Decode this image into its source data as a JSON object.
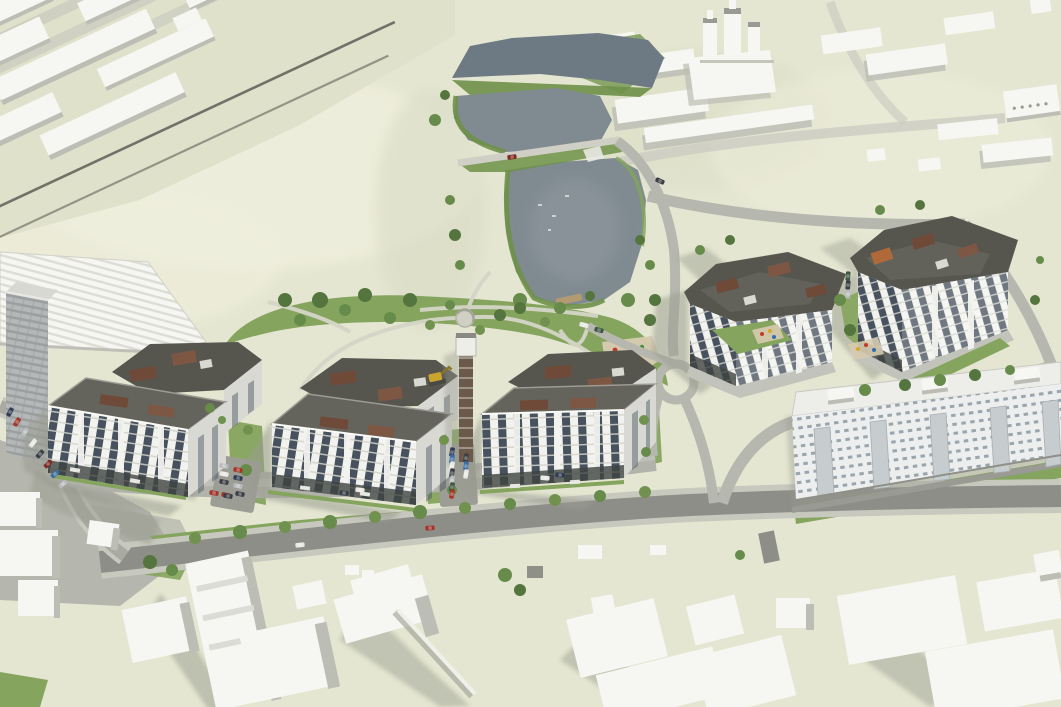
{
  "scene": {
    "type": "3d-architectural-rendering",
    "view": "aerial-axonometric",
    "description": "Aerial 3D visualization of a residential masterplan: a row of new white apartment blocks with dark roofs and brown penthouse accents along a tree-lined main road, a two-lobed pond with green banks and a dam road at the top, a landscaped park with winding paths and a playground, parking rows with cars, a construction hoist tower, white low-poly context buildings with a church complex on the upper plateau, railway corridor at top-left, and a long existing panel building at lower right.",
    "elements": [
      "terrain-hill",
      "railway-corridor",
      "context-buildings-north",
      "church-complex",
      "pond-upper",
      "pond-lower",
      "dam-road",
      "park-with-paths",
      "playground",
      "residential-cluster-a",
      "residential-cluster-b",
      "residential-cluster-c",
      "residential-cluster-d",
      "residential-cluster-e",
      "construction-tower",
      "excavator",
      "main-road",
      "ring-road",
      "parking-lots",
      "parked-cars",
      "panel-building",
      "context-buildings-south",
      "trees",
      "amphitheater-plaza",
      "pier"
    ]
  },
  "palette": {
    "terrain": "#e4e6d1",
    "hill-light": "#f0efde",
    "ground-nw": "#dfe1cb",
    "ground-shade": "#d8dac4",
    "yard-gray": "#b2b3ab",
    "pad": "#c2c3ba",
    "asphalt": "#8d8e88",
    "road-light": "#a9aaa2",
    "road-pale": "#b6b7ae",
    "sidewalk": "#c7c8be",
    "path": "#d6d6c8",
    "dam-road": "#cfcfc5",
    "water-dark": "#6e7a83",
    "water-mid": "#7f8a91",
    "water-light": "#919a9f",
    "lawn": "#85a45e",
    "lawn-dark": "#6e9048",
    "tree-dark": "#55753f",
    "tree-mid": "#678b4a",
    "bush": "#71914f",
    "facade": "#f2f2ee",
    "facade-shade": "#d9d9d3",
    "window": "#47525e",
    "floorline": "#d2d3cb",
    "roof-dark": "#56564f",
    "roof-mid": "#64645d",
    "parapet": "#9c9c94",
    "roofbox": "#d9d9d2",
    "plinth": "#3e4340",
    "accent-brown": "#6f4a38",
    "accent-brown2": "#7d5744",
    "accent-orange": "#b06a3a",
    "context-white": "#f6f6f2",
    "context-shade": "#bcbdb4",
    "shadow-strong": "#999b8f",
    "shadow-soft": "#b9bbab",
    "panel-facade": "#edefef",
    "panel-dot": "#9aa5ac",
    "panel-balcony": "#c7ccce",
    "panel-roof": "#ededea",
    "slab-gray": "#b5b8b9",
    "slab-line": "#9c9fa0",
    "rib": "#ddddd6",
    "sand": "#d7cbb0",
    "pier-wood": "#b49a72",
    "car-red": "#a33529",
    "car-red2": "#7e2a22",
    "car-blue": "#3a6ea5",
    "car-navy": "#303c52",
    "car-white": "#e8e8e4",
    "car-silver": "#b9bcbe",
    "car-dark": "#3a3f46",
    "car-green": "#3d5743",
    "car-yellow": "#c9a42e",
    "play-red": "#c23b2d",
    "play-yellow": "#d7a92c",
    "play-blue": "#2f6fae",
    "play-green": "#3f8f3f"
  }
}
